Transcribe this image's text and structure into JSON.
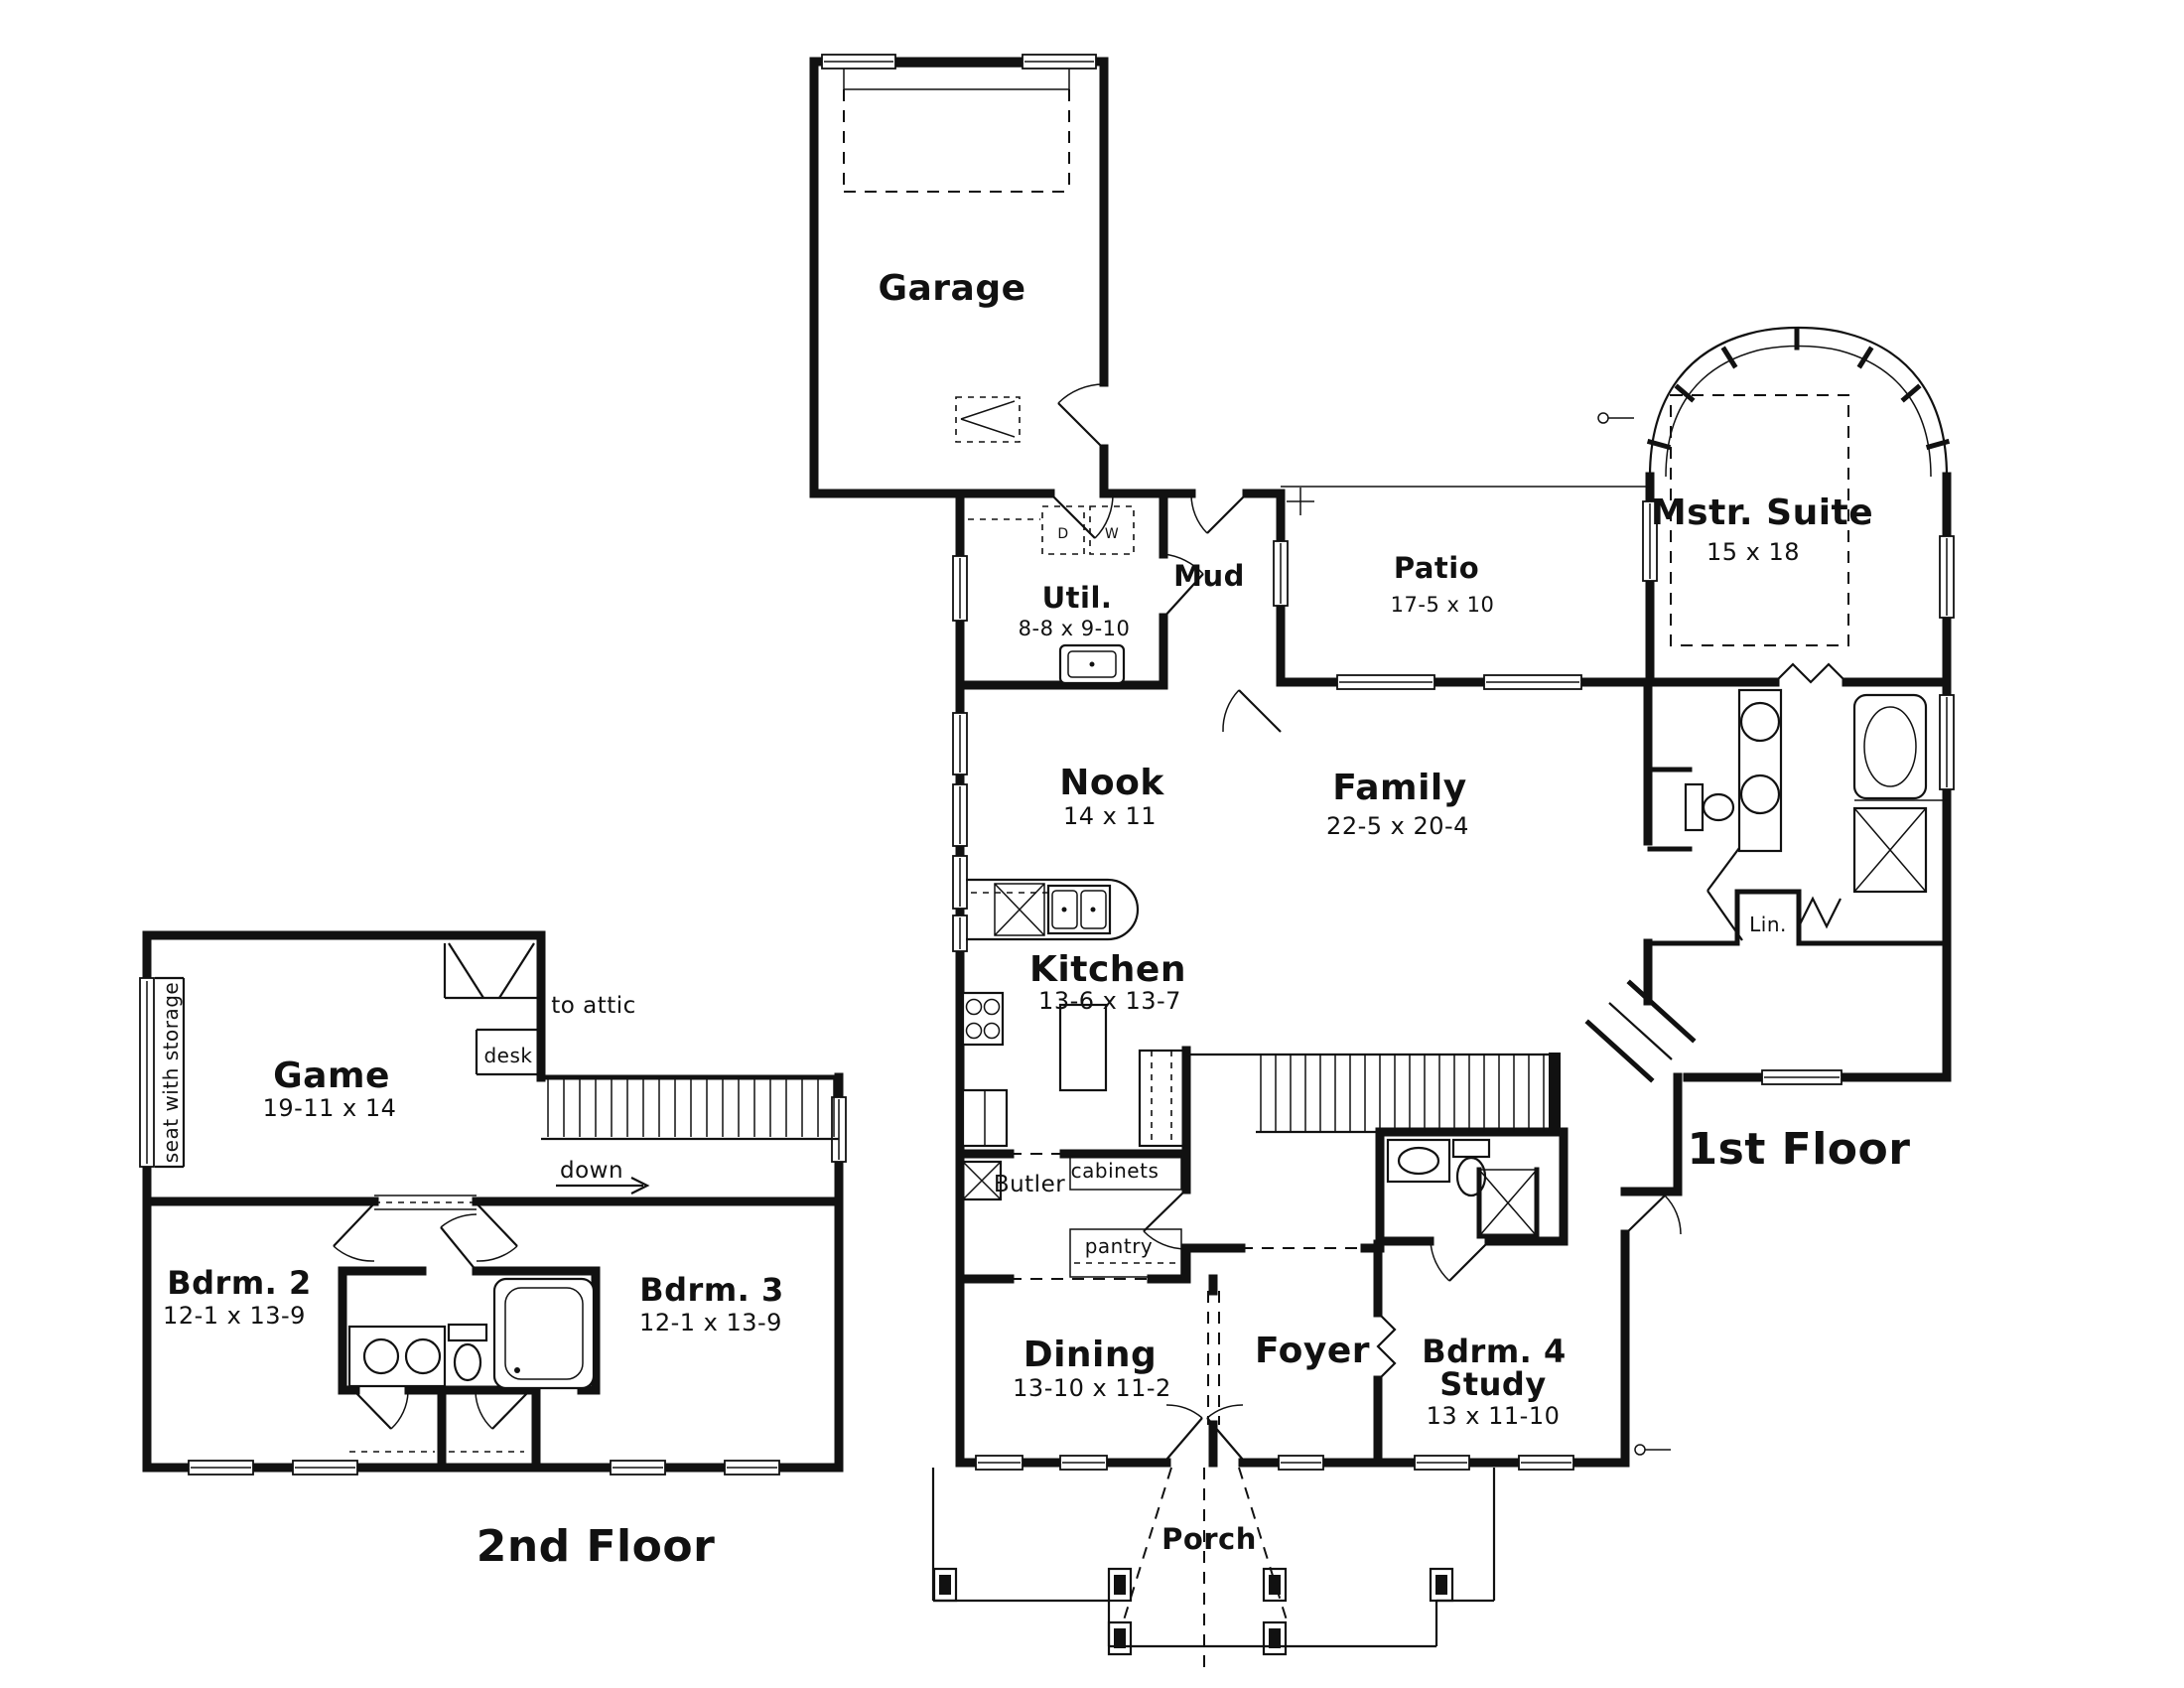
{
  "page": {
    "background": "#ffffff",
    "ink": "#111111",
    "type": "architectural floor plan"
  },
  "second_floor": {
    "title": "2nd Floor",
    "game": {
      "name": "Game",
      "dims": "19-11 x 14"
    },
    "bdrm2": {
      "name": "Bdrm. 2",
      "dims": "12-1 x 13-9"
    },
    "bdrm3": {
      "name": "Bdrm. 3",
      "dims": "12-1 x 13-9"
    },
    "labels": {
      "seat": "seat with storage",
      "to_attic": "to attic",
      "desk": "desk",
      "down": "down"
    }
  },
  "first_floor": {
    "title": "1st Floor",
    "garage": {
      "name": "Garage"
    },
    "util": {
      "name": "Util.",
      "dims": "8-8 x 9-10"
    },
    "mud": {
      "name": "Mud"
    },
    "patio": {
      "name": "Patio",
      "dims": "17-5 x 10"
    },
    "master": {
      "name": "Mstr. Suite",
      "dims": "15 x 18"
    },
    "nook": {
      "name": "Nook",
      "dims": "14 x 11"
    },
    "family": {
      "name": "Family",
      "dims": "22-5 x 20-4"
    },
    "kitchen": {
      "name": "Kitchen",
      "dims": "13-6 x 13-7"
    },
    "dining": {
      "name": "Dining",
      "dims": "13-10 x 11-2"
    },
    "foyer": {
      "name": "Foyer"
    },
    "bdrm4": {
      "name": "Bdrm. 4",
      "name2": "Study",
      "dims": "13 x 11-10"
    },
    "porch": {
      "name": "Porch"
    },
    "labels": {
      "butler": "Butler",
      "cabinets": "cabinets",
      "pantry": "pantry",
      "lin": "Lin.",
      "washer": "W",
      "dryer": "D"
    }
  }
}
